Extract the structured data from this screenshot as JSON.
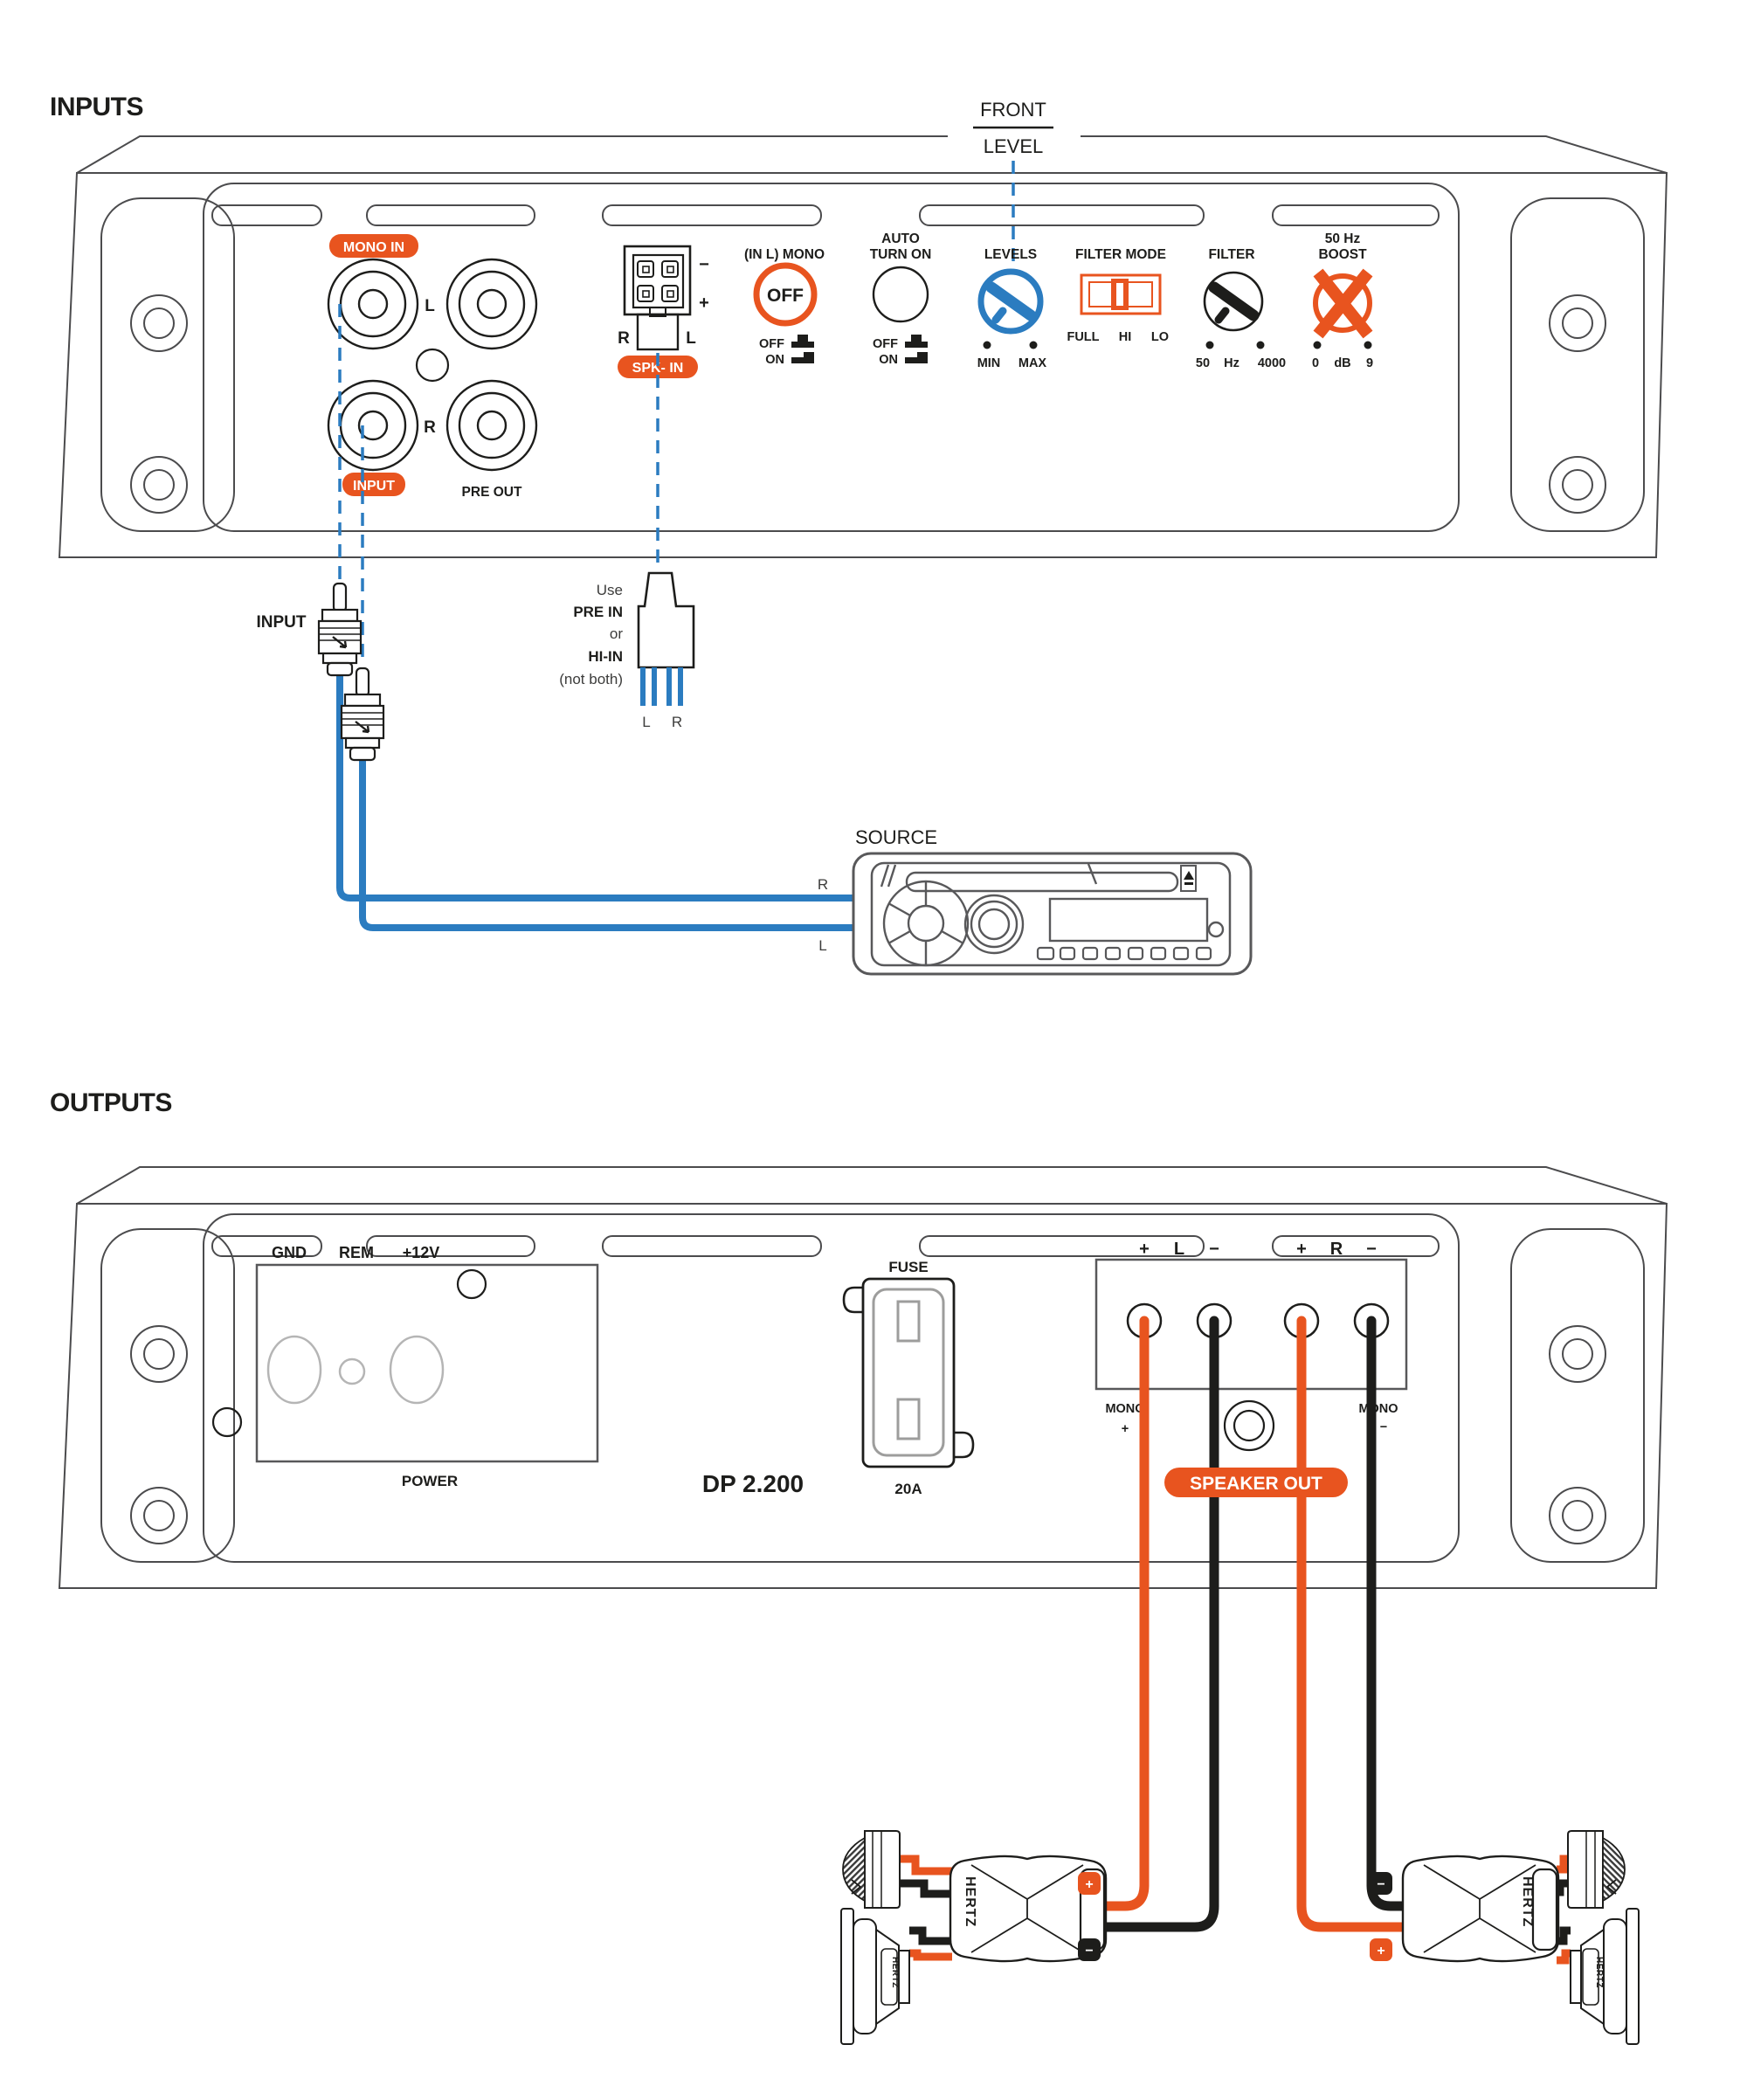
{
  "colors": {
    "orange": "#e8541f",
    "blue": "#2b7cc0",
    "ink": "#1d1d1b",
    "line": "#4b4b4d"
  },
  "inputs": {
    "title": "INPUTS",
    "front": "FRONT",
    "level": "LEVEL",
    "mono_in_badge": "MONO IN",
    "input_badge": "INPUT",
    "pre_out": "PRE OUT",
    "rca_l": "L",
    "rca_r": "R",
    "spk": {
      "minus": "−",
      "plus": "+",
      "r": "R",
      "l": "L",
      "badge": "SPK- IN"
    },
    "controls": {
      "in_l_mono": "(IN L) MONO",
      "off_knob": "OFF",
      "auto_1": "AUTO",
      "auto_2": "TURN ON",
      "sw_off": "OFF",
      "sw_on": "ON",
      "levels": "LEVELS",
      "min": "MIN",
      "max": "MAX",
      "filter_mode": "FILTER MODE",
      "full": "FULL",
      "hi": "HI",
      "lo": "LO",
      "filter": "FILTER",
      "f_min": "50",
      "f_unit": "Hz",
      "f_max": "4000",
      "boost_1": "50 Hz",
      "boost_2": "BOOST",
      "b_min": "0",
      "b_unit": "dB",
      "b_max": "9"
    },
    "note": {
      "use": "Use",
      "pre_in": "PRE IN",
      "or": "or",
      "hi_in": "HI-IN",
      "not_both": "(not both)",
      "l": "L",
      "r": "R"
    },
    "input_plugs_label": "INPUT",
    "source": {
      "label": "SOURCE",
      "r": "R",
      "l": "L"
    }
  },
  "outputs": {
    "title": "OUTPUTS",
    "power": {
      "gnd": "GND",
      "rem": "REM",
      "v12": "+12V",
      "label": "POWER"
    },
    "model": "DP 2.200",
    "fuse": {
      "label": "FUSE",
      "rating": "20A"
    },
    "terminals": {
      "plus": "+",
      "minus": "−",
      "l": "L",
      "r": "R",
      "mono": "MONO",
      "badge": "SPEAKER OUT"
    },
    "speakers": {
      "brand": "HERTZ"
    }
  }
}
